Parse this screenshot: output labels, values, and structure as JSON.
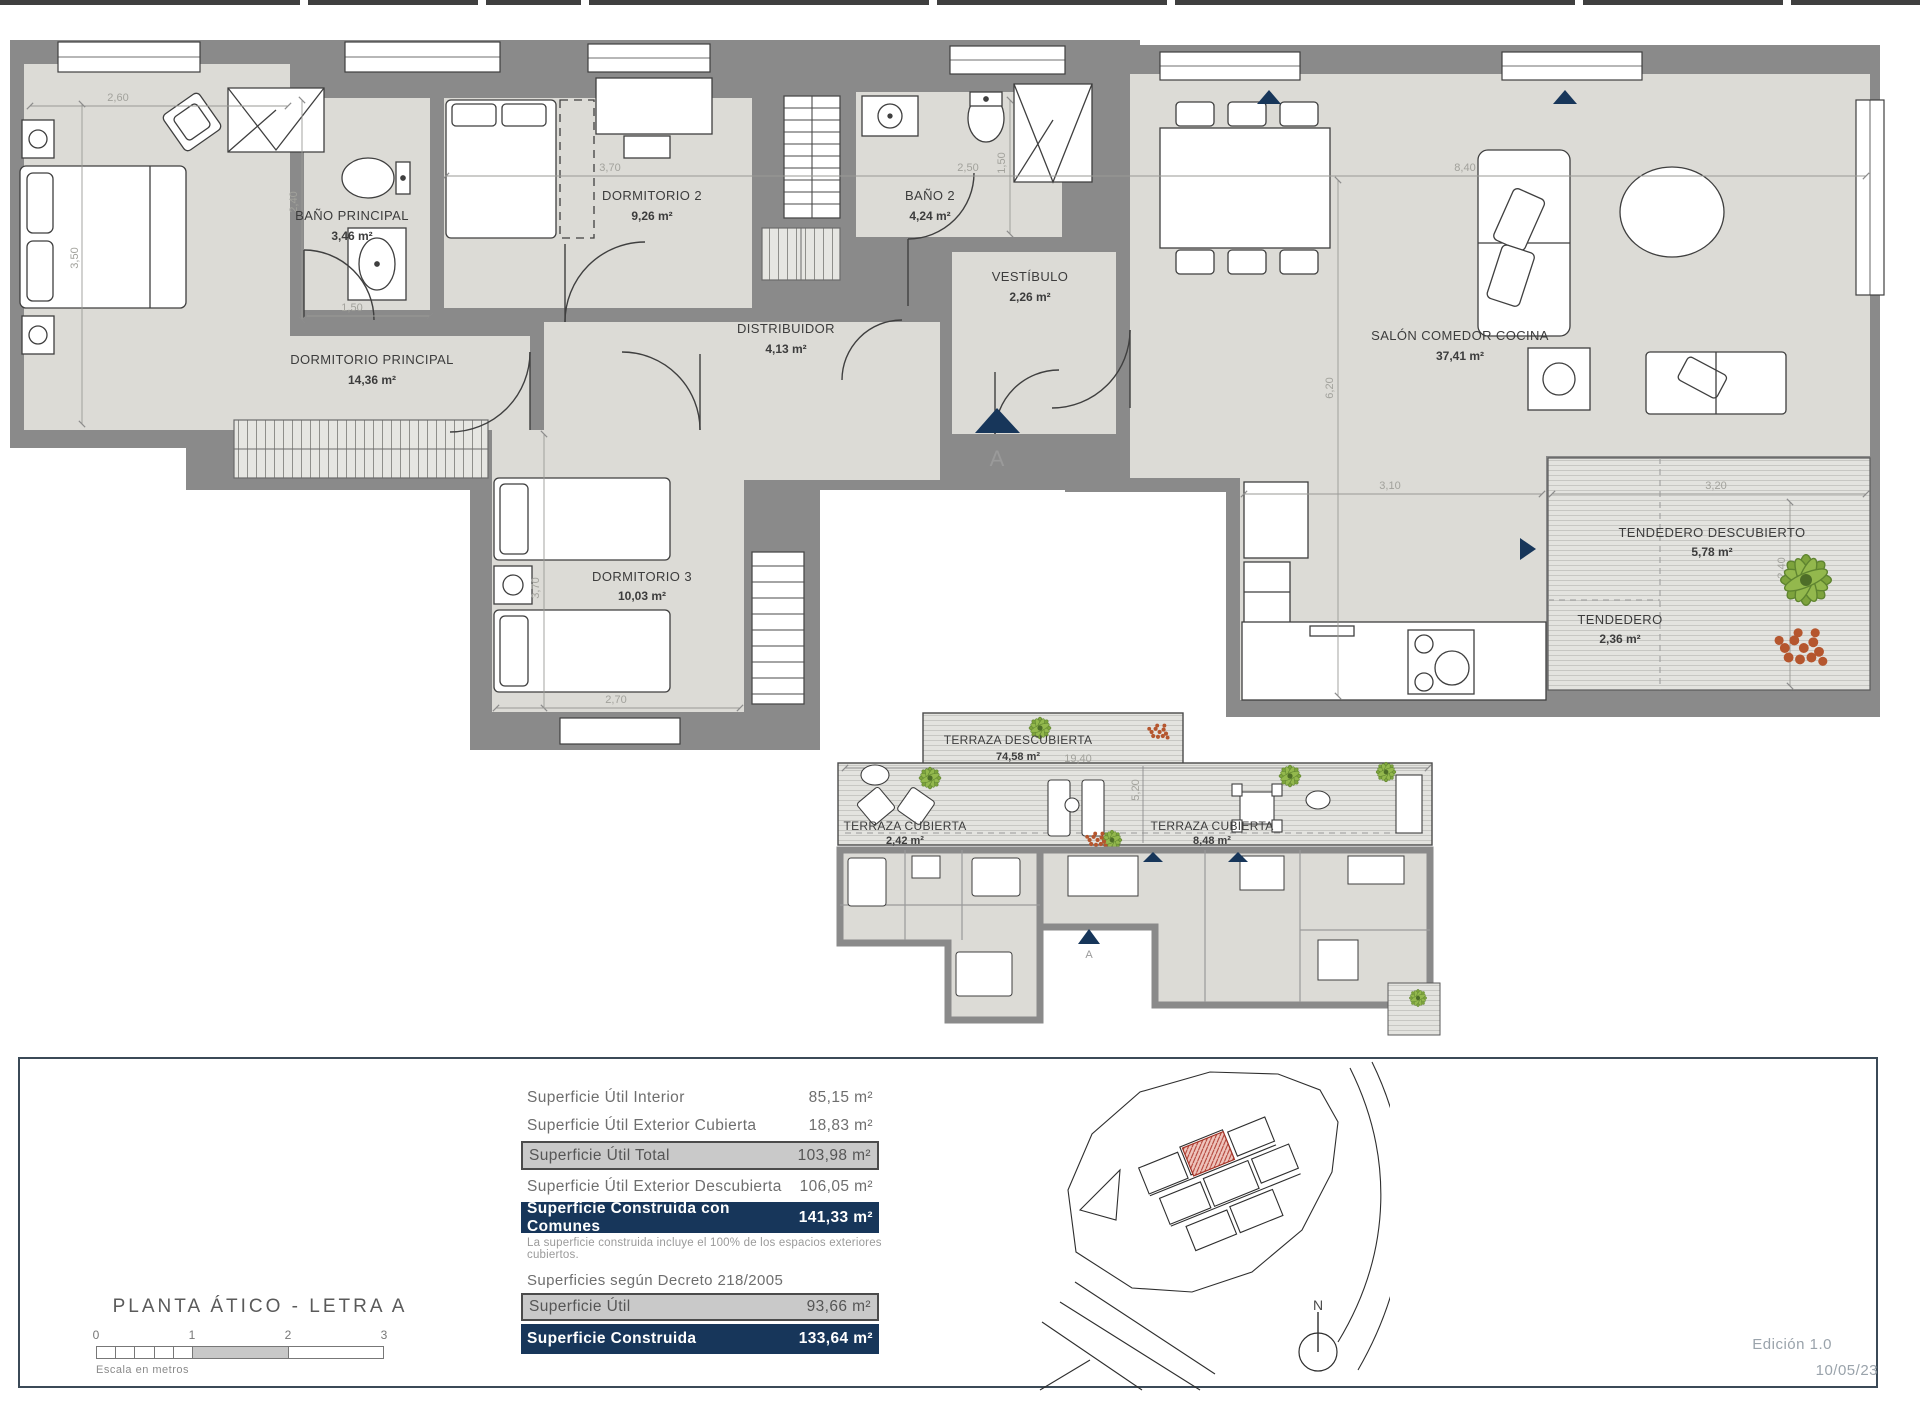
{
  "colors": {
    "wall": "#8a8a8a",
    "room_fill": "#dcdbd6",
    "navy": "#17365a",
    "row_gray": "#c9c9c9",
    "red_unit": "#b03a2e",
    "dim_text": "#a2a29c"
  },
  "plan": {
    "rooms": [
      {
        "name": "DORMITORIO PRINCIPAL",
        "area": "14,36 m²"
      },
      {
        "name": "BAÑO PRINCIPAL",
        "area": "3,46 m²"
      },
      {
        "name": "DORMITORIO 2",
        "area": "9,26 m²"
      },
      {
        "name": "BAÑO 2",
        "area": "4,24 m²"
      },
      {
        "name": "VESTÍBULO",
        "area": "2,26 m²"
      },
      {
        "name": "DISTRIBUIDOR",
        "area": "4,13 m²"
      },
      {
        "name": "DORMITORIO 3",
        "area": "10,03 m²"
      },
      {
        "name": "SALÓN COMEDOR COCINA",
        "area": "37,41 m²"
      },
      {
        "name": "TENDEDERO DESCUBIERTO",
        "area": "5,78 m²"
      },
      {
        "name": "TENDEDERO",
        "area": "2,36 m²"
      }
    ],
    "dims": [
      "2,60",
      "3,50",
      "2,40",
      "1,50",
      "3,70",
      "2,50",
      "1,50",
      "8,40",
      "6,20",
      "3,10",
      "3,20",
      "2,40",
      "3,70",
      "2,70"
    ],
    "section_marker": "A"
  },
  "terrace": {
    "rooms": [
      {
        "name": "TERRAZA DESCUBIERTA",
        "area": "74,58 m²"
      },
      {
        "name": "TERRAZA CUBIERTA",
        "area": "2,42 m²"
      },
      {
        "name": "TERRAZA CUBIERTA",
        "area": "8,48 m²"
      }
    ],
    "dims": [
      "19,40",
      "5,20"
    ],
    "section_marker": "A"
  },
  "footer": {
    "title": "PLANTA ÁTICO - LETRA A",
    "scale_ticks": [
      "0",
      "1",
      "2",
      "3"
    ],
    "scale_caption": "Escala en metros",
    "summary_rows": [
      {
        "label": "Superficie Útil Interior",
        "value": "85,15 m²"
      },
      {
        "label": "Superficie Útil Exterior Cubierta",
        "value": "18,83 m²"
      },
      {
        "label": "Superficie Útil Total",
        "value": "103,98 m²"
      },
      {
        "label": "Superficie Útil Exterior Descubierta",
        "value": "106,05 m²"
      },
      {
        "label": "Superficie Construida con Comunes",
        "value": "141,33 m²"
      }
    ],
    "summary_note": "La superficie construida incluye el 100% de los espacios exteriores cubiertos.",
    "decree_heading": "Superficies según Decreto 218/2005",
    "decree_rows": [
      {
        "label": "Superficie Útil",
        "value": "93,66 m²"
      },
      {
        "label": "Superficie Construida",
        "value": "133,64 m²"
      }
    ],
    "north_label": "N",
    "edition": "Edición 1.0",
    "date": "10/05/23"
  }
}
